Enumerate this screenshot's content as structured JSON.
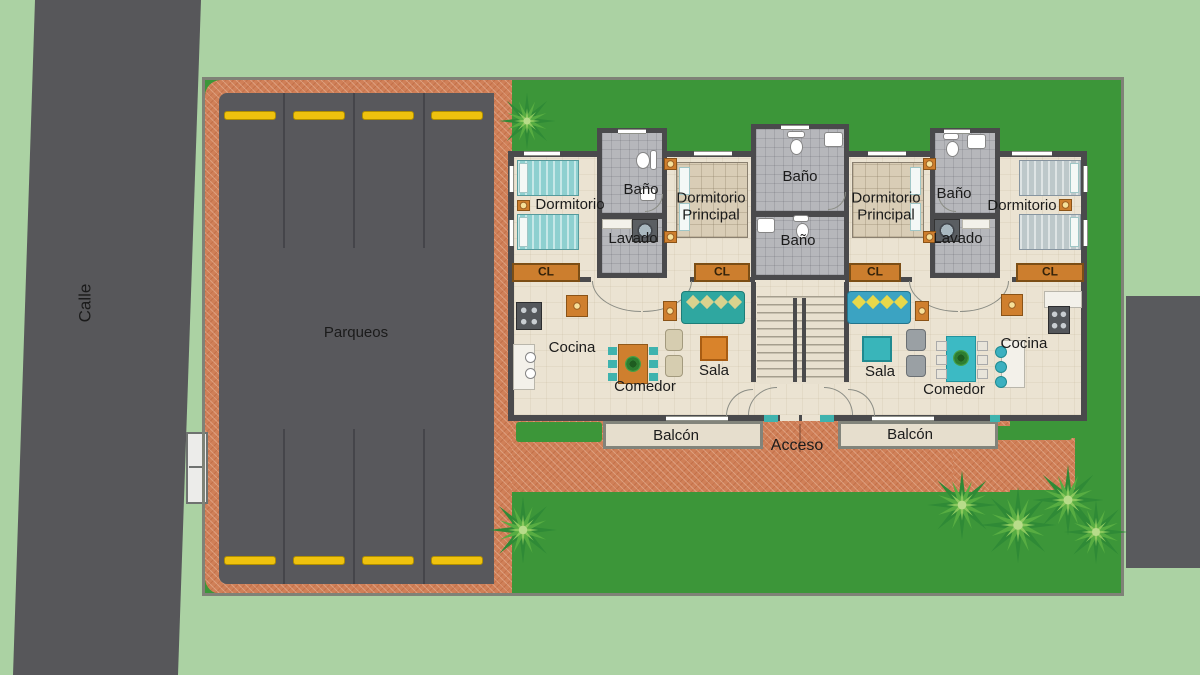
{
  "site": {
    "street": {
      "label": "Calle"
    },
    "parking": {
      "label": "Parqueos",
      "stalls_top": 4,
      "stalls_bottom": 4
    },
    "access": {
      "label": "Acceso"
    }
  },
  "apartment_rooms": {
    "bedroom": "Dormitorio",
    "master_bedroom": [
      "Dormitorio",
      "Principal"
    ],
    "bathroom": "Baño",
    "laundry": "Lavado",
    "closet": "CL",
    "kitchen": "Cocina",
    "dining": "Comedor",
    "living": "Sala",
    "balcony": "Balcón"
  },
  "colors": {
    "background_green": "#abd2a3",
    "lawn_green": "#3c9639",
    "asphalt_gray": "#58585c",
    "paver_terracotta": "#d08058",
    "wall_gray": "#4a4a4c",
    "floor_beige": "#ebe3d2",
    "bath_tile_gray": "#b6b7bb",
    "closet_orange": "#cc7e2e",
    "wheel_stop_yellow": "#efc20e",
    "window_accent_teal": "#3fb3ae"
  }
}
